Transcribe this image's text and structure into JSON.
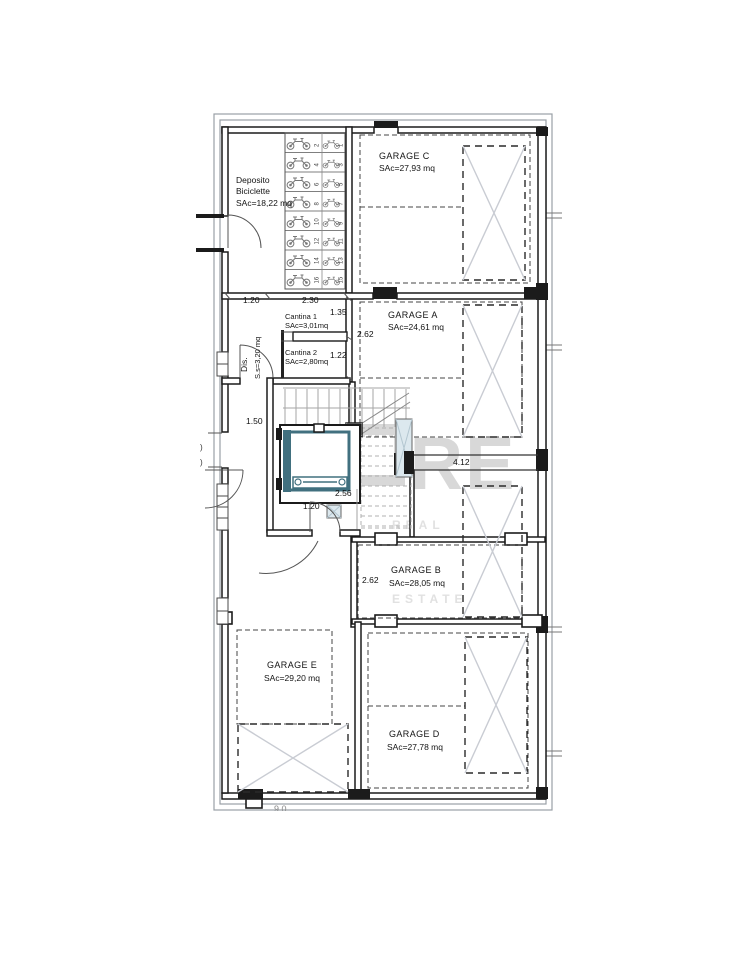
{
  "watermark": {
    "letter_m": "M",
    "letters_re": "RE",
    "tagline": "REAL ESTATE"
  },
  "rooms": {
    "deposito": {
      "name_line1": "Deposito",
      "name_line2": "Biciclette",
      "area": "SAc=18,22 mq"
    },
    "garage_c": {
      "name": "GARAGE C",
      "area": "SAc=27,93 mq"
    },
    "garage_a": {
      "name": "GARAGE A",
      "area": "SAc=24,61 mq"
    },
    "garage_b": {
      "name": "GARAGE B",
      "area": "SAc=28,05 mq"
    },
    "garage_d": {
      "name": "GARAGE D",
      "area": "SAc=27,78 mq"
    },
    "garage_e": {
      "name": "GARAGE E",
      "area": "SAc=29,20 mq"
    },
    "cantina_1": {
      "name": "Cantina 1",
      "area": "SAc=3,01mq"
    },
    "cantina_2": {
      "name": "Cantina 2",
      "area": "SAc=2,80mq"
    },
    "dis": {
      "name": "Dis.",
      "area": "S.s=3,20 mq"
    }
  },
  "dimensions": {
    "deposito_door": "1.20",
    "cantina_width": "2.30",
    "cantina1_depth": "1.35",
    "garage_a_side": "2.62",
    "cantina2_depth": "1.22",
    "exterior_door": "1.50",
    "corridor_length": "4.12",
    "landing_width": "2.56",
    "landing_door": "1.20",
    "garage_b_side": "2.62",
    "clip_left_1": ")",
    "clip_left_2": ")",
    "clip_bottom": "9,0"
  },
  "bike_stalls": {
    "left": [
      "2",
      "4",
      "6",
      "8",
      "10",
      "12",
      "14",
      "16"
    ],
    "right": [
      "1",
      "3",
      "5",
      "7",
      "9",
      "11",
      "13",
      "15"
    ]
  },
  "colors": {
    "wall": "#1b1b1b",
    "elevator_accent": "#41707f",
    "parking_mark": "#c9ccd3",
    "watermark": "#d8d8d8",
    "boundary_gray": "#9aa0a6"
  }
}
